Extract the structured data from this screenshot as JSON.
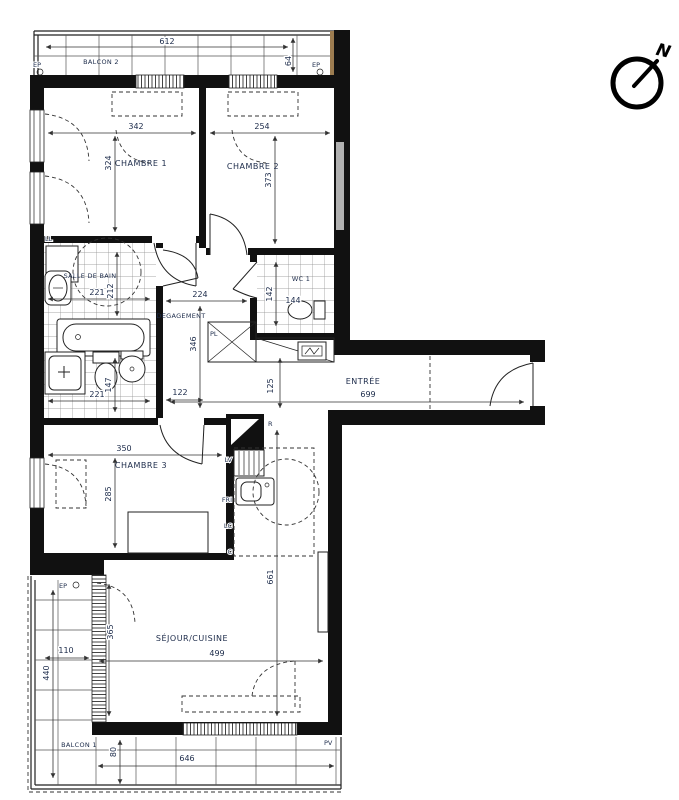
{
  "colors": {
    "wall": "#111111",
    "label": "#1c2b4a",
    "dim": "#222222",
    "tile_line": "#8a8a8a",
    "corner_trim": "#9c7c50"
  },
  "compass": {
    "north": "N"
  },
  "rooms": {
    "balcon2": "BALCON 2",
    "chambre1": "CHAMBRE 1",
    "chambre2": "CHAMBRE 2",
    "salle_de_bain": "SALLE DE BAIN",
    "wc": "WC 1",
    "degagement": "DEGAGEMENT",
    "entree": "ENTRÉE",
    "chambre3": "CHAMBRE 3",
    "sejour": "SÉJOUR/CUISINE",
    "balcon1": "BALCON 1"
  },
  "dims": {
    "balcon2_w": "612",
    "balcon2_d": "64",
    "chambre1_w": "342",
    "chambre1_d": "324",
    "chambre2_w": "254",
    "chambre2_d": "373",
    "sdb_w": "221",
    "sdb_d": "212",
    "sdb_w2": "221",
    "sdb_d2": "147",
    "wc_d": "142",
    "wc_w": "144",
    "deg_w": "224",
    "deg_d": "346",
    "deg_w2": "122",
    "entree_l": "699",
    "entree_w": "125",
    "chambre3_w": "350",
    "chambre3_d": "285",
    "sejour_w": "499",
    "sejour_d": "661",
    "sejour_d2": "365",
    "balcon1_col_w": "110",
    "balcon1_col_d": "440",
    "balcon1_d": "80",
    "balcon1_w": "646"
  },
  "tags": {
    "ep": "EP",
    "ll": "LL",
    "pl": "PL",
    "pv": "PV",
    "shaft": "R",
    "lv": "LV",
    "fri": "FRI",
    "lc": "LC",
    "c": "C"
  }
}
